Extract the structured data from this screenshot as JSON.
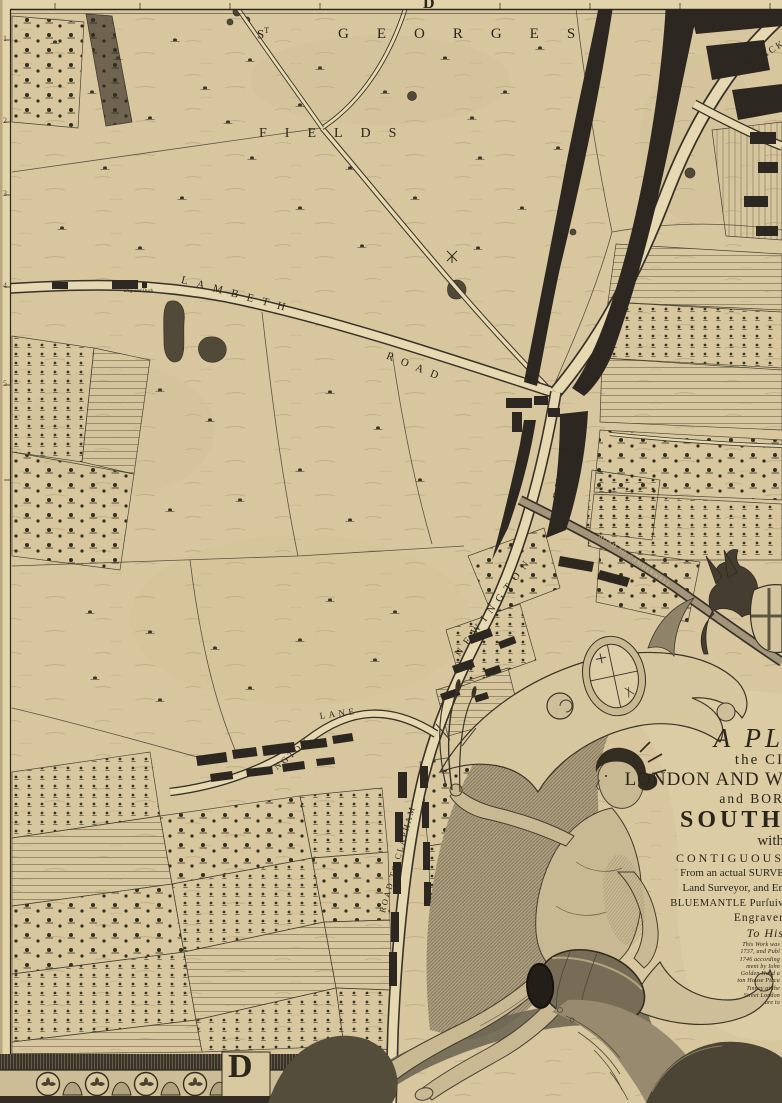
{
  "palette": {
    "paper": "#d8c79e",
    "paper_light": "#e2d3ab",
    "ink": "#2b261c",
    "road_fill": "#e6d8b0",
    "building": "#2c2720",
    "engraving": "#4e4636"
  },
  "frame": {
    "top_grid_letter": "D",
    "bottom_grid_letter": "D",
    "left_margin_numbers": [
      "1",
      "2",
      "3",
      "4",
      "5"
    ]
  },
  "map_labels": {
    "st_base": "S",
    "st_sup": "T",
    "georges": "GEORGES",
    "fields": "FIELDS",
    "lambeth": "LAMBETH",
    "road_word": "ROAD",
    "newington": "NEWINGTON",
    "butts": "BUTTS",
    "road_to_clapham": "ROAD TO CLAPHAM",
    "lane_part1": "NGTON",
    "lane_part2": "LANE",
    "road_to_camberwell": "ROAD TO CAMBERWELL",
    "blackman_fragment": "BLACK",
    "dog_and_duck": "Dog and Duck"
  },
  "cartouche": {
    "title_lines": [
      "A PL",
      "the CI",
      "LONDON AND W",
      "and BOR",
      "SOUTH",
      "with",
      "CONTIGUOUS",
      "From an actual SURVE",
      "Land Surveyor, and En",
      "BLUEMANTLE Purſuiv",
      "Engraver",
      "To His"
    ],
    "imprint_lines": [
      "This Work was",
      "1737, and Publ",
      "1746 according",
      "ment by Iohn",
      "Golden Head a",
      "ton House Picca",
      "Tinney at the",
      "Street London",
      "are to"
    ]
  }
}
